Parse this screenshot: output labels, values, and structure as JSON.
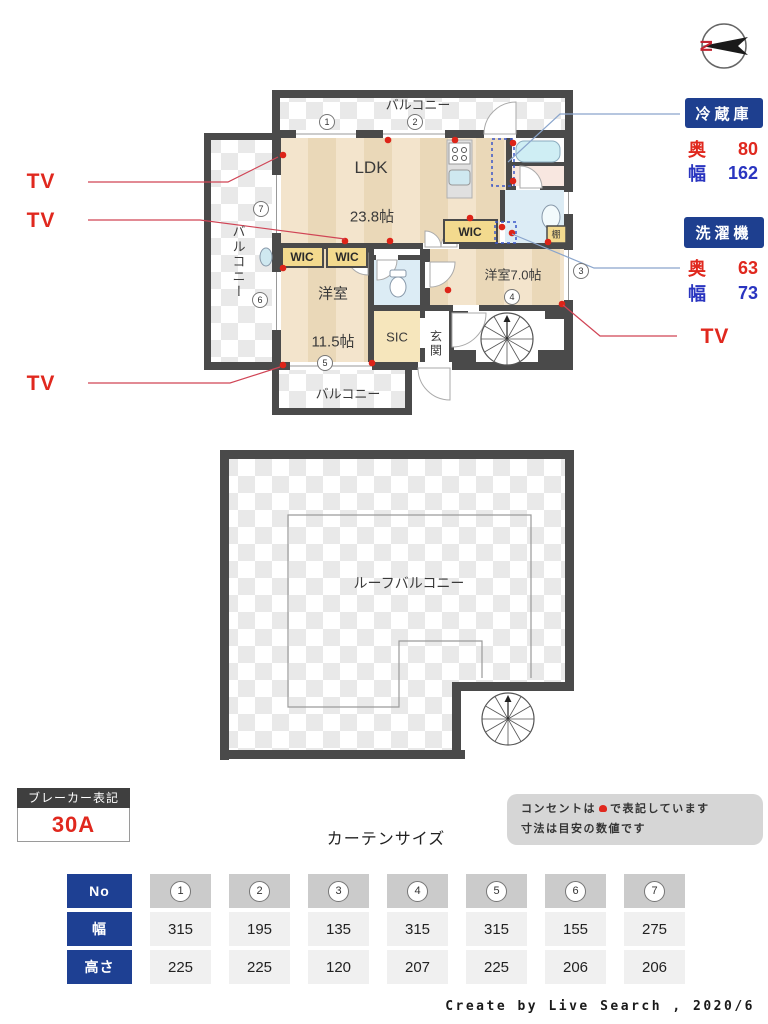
{
  "compass": {
    "north": "N"
  },
  "legend": {
    "tv": [
      "TV",
      "TV",
      "TV",
      "TV"
    ],
    "fridge": {
      "title": "冷蔵庫",
      "rows": [
        {
          "label": "奥",
          "value": "80"
        },
        {
          "label": "幅",
          "value": "162"
        }
      ]
    },
    "washer": {
      "title": "洗濯機",
      "rows": [
        {
          "label": "奥",
          "value": "63"
        },
        {
          "label": "幅",
          "value": "73"
        }
      ]
    }
  },
  "plan": {
    "balcony_top": "バルコニー",
    "balcony_left": "バルコニー",
    "balcony_bottom": "バルコニー",
    "ldk": "LDK",
    "ldk_size": "23.8帖",
    "bedroom1": "洋室",
    "bedroom1_size": "11.5帖",
    "bedroom2": "洋室7.0帖",
    "wic_a": "WIC",
    "wic_b": "WIC",
    "wic_c": "WIC",
    "sic": "SIC",
    "entrance": "玄関",
    "shelf": "棚",
    "circled": [
      "1",
      "2",
      "3",
      "4",
      "5",
      "6",
      "7"
    ]
  },
  "roof": {
    "label": "ルーフバルコニー"
  },
  "breaker": {
    "title": "ブレーカー表記",
    "value": "30A"
  },
  "note": {
    "line1_prefix": "コンセントは",
    "line1_suffix": "で表記しています",
    "line2": "寸法は目安の数値です"
  },
  "curtain": {
    "title": "カーテンサイズ",
    "row_headers": [
      "No",
      "幅",
      "高さ"
    ],
    "cols": [
      {
        "no": "1",
        "width": "315",
        "height": "225"
      },
      {
        "no": "2",
        "width": "195",
        "height": "225"
      },
      {
        "no": "3",
        "width": "135",
        "height": "120"
      },
      {
        "no": "4",
        "width": "315",
        "height": "207"
      },
      {
        "no": "5",
        "width": "315",
        "height": "225"
      },
      {
        "no": "6",
        "width": "155",
        "height": "206"
      },
      {
        "no": "7",
        "width": "275",
        "height": "206"
      }
    ]
  },
  "credit": "Create by Live Search , 2020/6",
  "colors": {
    "navy": "#1e3f8f",
    "red": "#e0281e",
    "blue": "#2a35c0",
    "wall": "#4a4a4a"
  }
}
